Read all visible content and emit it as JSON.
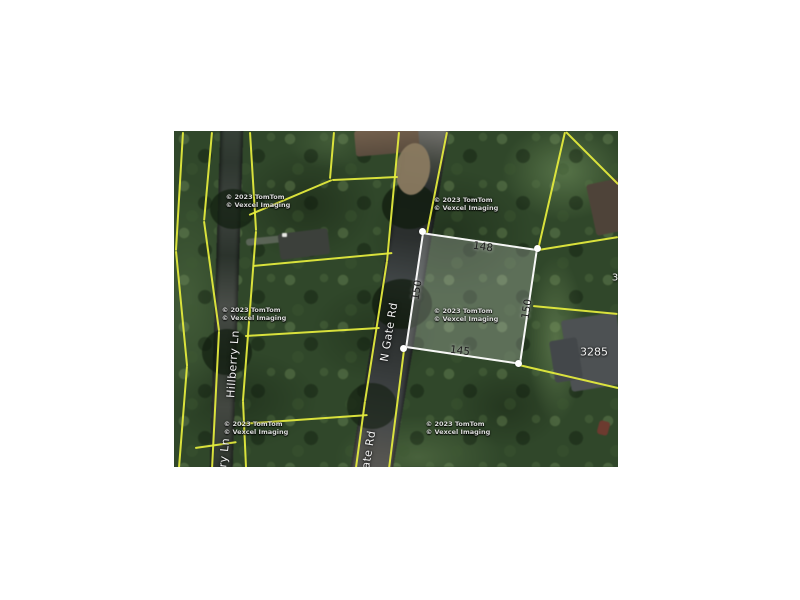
{
  "map": {
    "street_labels": {
      "n_gate_rd": "N Gate Rd",
      "n_gate_rd_partial": "Gate Rd",
      "hillberry_ln": "Hillberry Ln",
      "hillberry_ln_partial": "rry Ln"
    },
    "highlighted_parcel": {
      "dim_top": "148",
      "dim_left": "150",
      "dim_right": "150",
      "dim_bottom": "145"
    },
    "house_numbers": {
      "main": "3285",
      "partial_right_edge": "3"
    },
    "watermark": {
      "line1": "© 2023 TomTom",
      "line2": "© Vexcel Imaging"
    },
    "colors": {
      "parcel_line": "#e3ea3d",
      "highlight_border": "#ffffff",
      "highlight_fill": "rgba(255,255,255,0.22)",
      "forest_base": "#2f4729"
    }
  }
}
